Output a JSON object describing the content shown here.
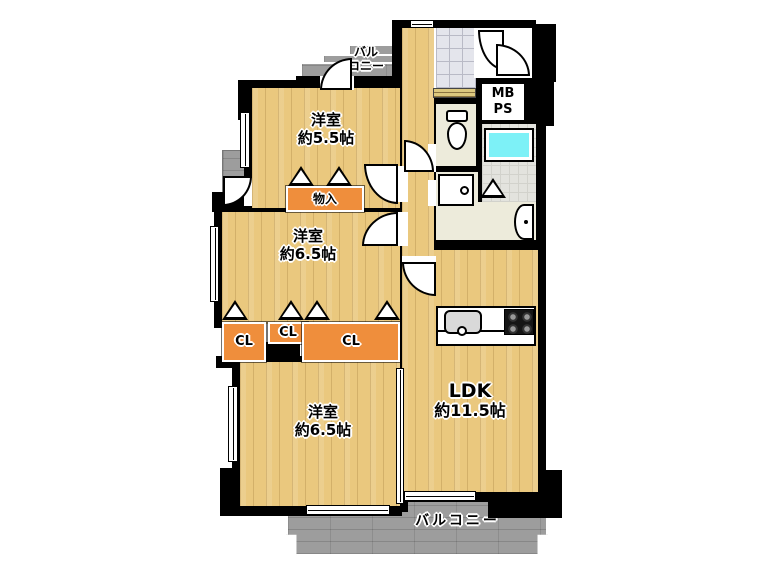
{
  "labels": {
    "balcony_top_line1": "バル",
    "balcony_top_line2": "コニー",
    "room_a_line1": "洋室",
    "room_a_line2": "約5.5帖",
    "storage": "物入",
    "room_c_line1": "洋室",
    "room_c_line2": "約6.5帖",
    "closet_left": "CL",
    "closet_middle": "CL",
    "closet_right": "CL",
    "room_e_line1": "洋室",
    "room_e_line2": "約6.5帖",
    "ldk_line1": "LDK",
    "ldk_line2": "約11.5帖",
    "meter_box_line1": "MB",
    "meter_box_line2": "PS",
    "balcony_bottom": "バルコニー"
  },
  "fixtures": {
    "bathtub": "cyan-rect",
    "toilet": "ellipse",
    "washbasin": "half-circle",
    "washing_machine_pan": "square-with-drain",
    "kitchen_sink": "rounded-rect",
    "gas_stove": "square-4-burners",
    "folding_door": "triangle",
    "swing_door": "quarter-arc",
    "window": "white-double-line"
  },
  "colors": {
    "wood": "#eac87e",
    "orange": "#ef8e3c",
    "balcony": "#9d9d9d",
    "wall": "#000000",
    "tub": "#7df1f7",
    "tile": "#e4e5ec",
    "service": "#edebdb",
    "bath_floor": "#e3e3de"
  }
}
